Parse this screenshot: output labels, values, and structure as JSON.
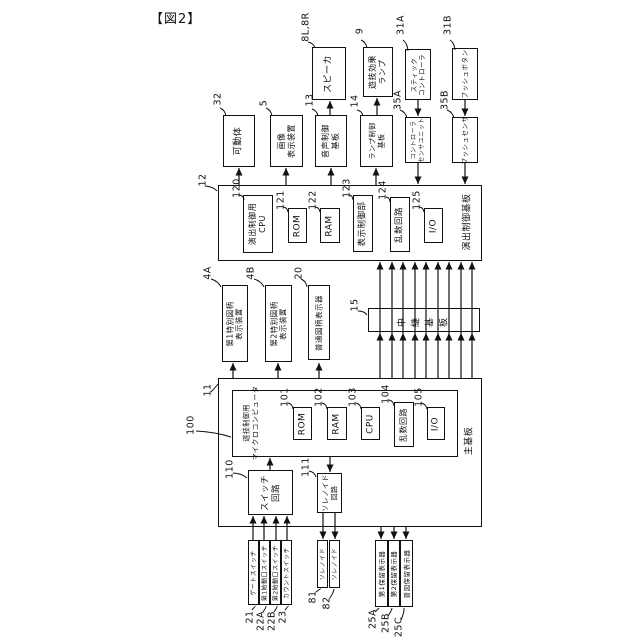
{
  "title": "【図2】",
  "colors": {
    "ink": "#111111",
    "bg": "#ffffff"
  },
  "boxes": [
    {
      "name": "speaker",
      "x": 312,
      "y": 47,
      "w": 34,
      "h": 53,
      "fs": 9,
      "lines": [
        "スピーカ"
      ]
    },
    {
      "name": "game-effect-lamp",
      "x": 363,
      "y": 47,
      "w": 30,
      "h": 50,
      "fs": 8,
      "lines": [
        "遊技効果",
        "ランプ"
      ]
    },
    {
      "name": "stick-controller",
      "x": 405,
      "y": 49,
      "w": 26,
      "h": 51,
      "fs": 6.5,
      "lines": [
        "スティック",
        "コントローラ"
      ]
    },
    {
      "name": "push-button",
      "x": 452,
      "y": 48,
      "w": 26,
      "h": 52,
      "fs": 6.5,
      "lines": [
        "プッシュボタン"
      ]
    },
    {
      "name": "movable-body",
      "x": 223,
      "y": 115,
      "w": 32,
      "h": 52,
      "fs": 9,
      "lines": [
        "可動体"
      ]
    },
    {
      "name": "image-display-device",
      "x": 270,
      "y": 115,
      "w": 33,
      "h": 52,
      "fs": 8,
      "lines": [
        "画像",
        "表示装置"
      ]
    },
    {
      "name": "sound-control-board",
      "x": 315,
      "y": 115,
      "w": 32,
      "h": 52,
      "fs": 8,
      "lines": [
        "音声制御",
        "基板"
      ]
    },
    {
      "name": "lamp-control-board",
      "x": 360,
      "y": 115,
      "w": 33,
      "h": 52,
      "fs": 7,
      "lines": [
        "ランプ制御",
        "基板"
      ]
    },
    {
      "name": "controller-sensor-unit",
      "x": 405,
      "y": 117,
      "w": 26,
      "h": 46,
      "fs": 6,
      "lines": [
        "コントローラ",
        "センサユニット"
      ]
    },
    {
      "name": "push-sensor",
      "x": 452,
      "y": 117,
      "w": 26,
      "h": 46,
      "fs": 6.5,
      "lines": [
        "プッシュセンサ"
      ]
    },
    {
      "name": "effect-control-board",
      "x": 218,
      "y": 185,
      "w": 264,
      "h": 76,
      "fs": 9,
      "lines": []
    },
    {
      "name": "effect-control-cpu",
      "x": 243,
      "y": 195,
      "w": 30,
      "h": 58,
      "fs": 8,
      "lines": [
        "演出制御用",
        "CPU"
      ]
    },
    {
      "name": "effect-rom",
      "x": 288,
      "y": 208,
      "w": 19,
      "h": 35,
      "fs": 9,
      "lines": [
        "ROM"
      ]
    },
    {
      "name": "effect-ram",
      "x": 320,
      "y": 208,
      "w": 20,
      "h": 35,
      "fs": 9,
      "lines": [
        "RAM"
      ]
    },
    {
      "name": "display-control-unit",
      "x": 353,
      "y": 195,
      "w": 20,
      "h": 57,
      "fs": 8.5,
      "lines": [
        "表示制御部"
      ]
    },
    {
      "name": "effect-random-circuit",
      "x": 390,
      "y": 197,
      "w": 20,
      "h": 55,
      "fs": 8.5,
      "lines": [
        "乱数回路"
      ]
    },
    {
      "name": "effect-io",
      "x": 424,
      "y": 208,
      "w": 19,
      "h": 35,
      "fs": 9,
      "lines": [
        "I/O"
      ]
    },
    {
      "name": "first-special-symbol-display",
      "x": 222,
      "y": 285,
      "w": 26,
      "h": 77,
      "fs": 7.5,
      "lines": [
        "第1特別図柄",
        "表示装置"
      ]
    },
    {
      "name": "second-special-symbol-display",
      "x": 265,
      "y": 285,
      "w": 27,
      "h": 77,
      "fs": 7.5,
      "lines": [
        "第2特別図柄",
        "表示装置"
      ]
    },
    {
      "name": "normal-symbol-display",
      "x": 308,
      "y": 285,
      "w": 22,
      "h": 75,
      "fs": 7.5,
      "lines": [
        "普通図柄表示器"
      ]
    },
    {
      "name": "relay-board",
      "x": 368,
      "y": 308,
      "w": 112,
      "h": 24,
      "fs": 9,
      "lines": [
        "中継基板"
      ],
      "charRotate": true
    },
    {
      "name": "main-board",
      "x": 218,
      "y": 378,
      "w": 264,
      "h": 149,
      "fs": 9,
      "lines": []
    },
    {
      "name": "game-control-microcomputer",
      "x": 232,
      "y": 390,
      "w": 226,
      "h": 67,
      "fs": 7,
      "lines": []
    },
    {
      "name": "main-rom",
      "x": 293,
      "y": 407,
      "w": 19,
      "h": 33,
      "fs": 9,
      "lines": [
        "ROM"
      ]
    },
    {
      "name": "main-ram",
      "x": 327,
      "y": 407,
      "w": 20,
      "h": 33,
      "fs": 9,
      "lines": [
        "RAM"
      ]
    },
    {
      "name": "main-cpu",
      "x": 361,
      "y": 407,
      "w": 19,
      "h": 33,
      "fs": 9,
      "lines": [
        "CPU"
      ]
    },
    {
      "name": "main-random-circuit",
      "x": 394,
      "y": 402,
      "w": 20,
      "h": 45,
      "fs": 8,
      "lines": [
        "乱数回路"
      ]
    },
    {
      "name": "main-io",
      "x": 427,
      "y": 407,
      "w": 18,
      "h": 33,
      "fs": 9,
      "lines": [
        "I/O"
      ]
    },
    {
      "name": "switch-circuit",
      "x": 248,
      "y": 470,
      "w": 45,
      "h": 45,
      "fs": 8.5,
      "lines": [
        "スイッチ",
        "回路"
      ]
    },
    {
      "name": "solenoid-circuit",
      "x": 317,
      "y": 473,
      "w": 25,
      "h": 40,
      "fs": 7,
      "lines": [
        "ソレノイド",
        "回路"
      ]
    },
    {
      "name": "gate-switch",
      "x": 248,
      "y": 540,
      "w": 11,
      "h": 65,
      "fs": 6,
      "lines": [
        "ゲートスイッチ"
      ]
    },
    {
      "name": "first-start-switch",
      "x": 259,
      "y": 540,
      "w": 11,
      "h": 65,
      "fs": 6,
      "lines": [
        "第1始動口スイッチ"
      ]
    },
    {
      "name": "second-start-switch",
      "x": 270,
      "y": 540,
      "w": 11,
      "h": 65,
      "fs": 6,
      "lines": [
        "第2始動口スイッチ"
      ]
    },
    {
      "name": "count-switch",
      "x": 281,
      "y": 540,
      "w": 11,
      "h": 65,
      "fs": 6,
      "lines": [
        "カウントスイッチ"
      ]
    },
    {
      "name": "solenoid-81",
      "x": 317,
      "y": 540,
      "w": 11,
      "h": 48,
      "fs": 6,
      "lines": [
        "ソレノイド"
      ]
    },
    {
      "name": "solenoid-82",
      "x": 329,
      "y": 540,
      "w": 11,
      "h": 48,
      "fs": 6,
      "lines": [
        "ソレノイド"
      ]
    },
    {
      "name": "first-hold-display",
      "x": 375,
      "y": 540,
      "w": 13,
      "h": 67,
      "fs": 6.5,
      "lines": [
        "第1保留表示器"
      ]
    },
    {
      "name": "second-hold-display",
      "x": 388,
      "y": 540,
      "w": 12,
      "h": 67,
      "fs": 6.5,
      "lines": [
        "第2保留表示器"
      ]
    },
    {
      "name": "normal-hold-display",
      "x": 400,
      "y": 540,
      "w": 13,
      "h": 67,
      "fs": 6.5,
      "lines": [
        "普図保留表示器"
      ]
    }
  ],
  "labels": [
    {
      "name": "effect-board-label",
      "cx": 468,
      "cy": 222,
      "fs": 9,
      "lines": [
        "演出制御基板"
      ]
    },
    {
      "name": "main-board-label",
      "cx": 470,
      "cy": 441,
      "fs": 9,
      "lines": [
        "主基板"
      ]
    },
    {
      "name": "microcomputer-label",
      "cx": 251,
      "cy": 423,
      "fs": 7,
      "lines": [
        "遊技制御用",
        "マイクロコンピュータ"
      ]
    }
  ],
  "refs": [
    [
      "8L,8R",
      306,
      27
    ],
    [
      "9",
      360,
      31
    ],
    [
      "31A",
      401,
      25
    ],
    [
      "31B",
      448,
      25
    ],
    [
      "32",
      218,
      99
    ],
    [
      "5",
      264,
      103
    ],
    [
      "13",
      310,
      100
    ],
    [
      "14",
      355,
      101
    ],
    [
      "35A",
      398,
      100
    ],
    [
      "35B",
      445,
      100
    ],
    [
      "12",
      203,
      180
    ],
    [
      "120",
      237,
      188
    ],
    [
      "121",
      281,
      200
    ],
    [
      "122",
      313,
      200
    ],
    [
      "123",
      347,
      188
    ],
    [
      "124",
      383,
      190
    ],
    [
      "125",
      417,
      200
    ],
    [
      "4A",
      208,
      273
    ],
    [
      "4B",
      251,
      273
    ],
    [
      "20",
      299,
      273
    ],
    [
      "15",
      355,
      305
    ],
    [
      "11",
      208,
      390
    ],
    [
      "100",
      191,
      425
    ],
    [
      "101",
      285,
      397
    ],
    [
      "102",
      319,
      397
    ],
    [
      "103",
      353,
      397
    ],
    [
      "104",
      386,
      394
    ],
    [
      "105",
      419,
      397
    ],
    [
      "110",
      230,
      469
    ],
    [
      "111",
      306,
      467
    ],
    [
      "21",
      250,
      617
    ],
    [
      "22A",
      261,
      621
    ],
    [
      "22B",
      272,
      621
    ],
    [
      "23",
      283,
      617
    ],
    [
      "81",
      313,
      597
    ],
    [
      "82",
      327,
      603
    ],
    [
      "25A",
      373,
      619
    ],
    [
      "25B",
      386,
      623
    ],
    [
      "25C",
      399,
      627
    ]
  ],
  "lines": [
    [
      330,
      115,
      330,
      101
    ],
    [
      377,
      115,
      377,
      98
    ],
    [
      418,
      100,
      418,
      116
    ],
    [
      465,
      100,
      465,
      116
    ],
    [
      418,
      163,
      418,
      184
    ],
    [
      465,
      163,
      465,
      184
    ],
    [
      239,
      185,
      239,
      168
    ],
    [
      286,
      185,
      286,
      168
    ],
    [
      331,
      185,
      331,
      168
    ],
    [
      376,
      185,
      376,
      168
    ],
    [
      380,
      378,
      380,
      262
    ],
    [
      392,
      378,
      392,
      262
    ],
    [
      403,
      378,
      403,
      262
    ],
    [
      415,
      378,
      415,
      262
    ],
    [
      426,
      378,
      426,
      262
    ],
    [
      438,
      378,
      438,
      262
    ],
    [
      449,
      378,
      449,
      262
    ],
    [
      461,
      378,
      461,
      262
    ],
    [
      472,
      378,
      472,
      262
    ],
    [
      233,
      378,
      233,
      363
    ],
    [
      278,
      378,
      278,
      363
    ],
    [
      319,
      378,
      319,
      363
    ],
    [
      270,
      470,
      270,
      458
    ],
    [
      330,
      457,
      330,
      472
    ],
    [
      253,
      540,
      253,
      516
    ],
    [
      264,
      540,
      264,
      516
    ],
    [
      276,
      540,
      276,
      516
    ],
    [
      287,
      540,
      287,
      516
    ],
    [
      323,
      513,
      323,
      539
    ],
    [
      335,
      513,
      335,
      539
    ],
    [
      381,
      527,
      381,
      539
    ],
    [
      394,
      527,
      394,
      539
    ],
    [
      406,
      527,
      406,
      539
    ]
  ],
  "arrowheads": [
    [
      330,
      101,
      "u"
    ],
    [
      377,
      98,
      "u"
    ],
    [
      418,
      116,
      "d"
    ],
    [
      465,
      116,
      "d"
    ],
    [
      418,
      184,
      "d"
    ],
    [
      465,
      184,
      "d"
    ],
    [
      239,
      168,
      "u"
    ],
    [
      286,
      168,
      "u"
    ],
    [
      331,
      168,
      "u"
    ],
    [
      376,
      168,
      "u"
    ],
    [
      380,
      262,
      "u"
    ],
    [
      392,
      262,
      "u"
    ],
    [
      403,
      262,
      "u"
    ],
    [
      415,
      262,
      "u"
    ],
    [
      426,
      262,
      "u"
    ],
    [
      438,
      262,
      "u"
    ],
    [
      449,
      262,
      "u"
    ],
    [
      461,
      262,
      "u"
    ],
    [
      472,
      262,
      "u"
    ],
    [
      380,
      333,
      "u"
    ],
    [
      392,
      333,
      "u"
    ],
    [
      403,
      333,
      "u"
    ],
    [
      415,
      333,
      "u"
    ],
    [
      426,
      333,
      "u"
    ],
    [
      438,
      333,
      "u"
    ],
    [
      449,
      333,
      "u"
    ],
    [
      461,
      333,
      "u"
    ],
    [
      472,
      333,
      "u"
    ],
    [
      233,
      363,
      "u"
    ],
    [
      278,
      363,
      "u"
    ],
    [
      319,
      363,
      "u"
    ],
    [
      270,
      458,
      "u"
    ],
    [
      330,
      472,
      "d"
    ],
    [
      253,
      516,
      "u"
    ],
    [
      264,
      516,
      "u"
    ],
    [
      276,
      516,
      "u"
    ],
    [
      287,
      516,
      "u"
    ],
    [
      323,
      539,
      "d"
    ],
    [
      335,
      539,
      "d"
    ],
    [
      381,
      539,
      "d"
    ],
    [
      394,
      539,
      "d"
    ],
    [
      406,
      539,
      "d"
    ]
  ],
  "leaders": [
    [
      308,
      42,
      315,
      48
    ],
    [
      361,
      40,
      367,
      48
    ],
    [
      403,
      40,
      408,
      51
    ],
    [
      450,
      40,
      455,
      50
    ],
    [
      220,
      108,
      226,
      116
    ],
    [
      266,
      108,
      272,
      116
    ],
    [
      312,
      109,
      318,
      116
    ],
    [
      357,
      110,
      363,
      116
    ],
    [
      400,
      110,
      407,
      118
    ],
    [
      447,
      110,
      454,
      118
    ],
    [
      205,
      186,
      217,
      191
    ],
    [
      239,
      195,
      244,
      200
    ],
    [
      283,
      207,
      288,
      212
    ],
    [
      315,
      207,
      320,
      212
    ],
    [
      349,
      195,
      353,
      200
    ],
    [
      386,
      197,
      390,
      202
    ],
    [
      419,
      207,
      424,
      212
    ],
    [
      211,
      279,
      221,
      287
    ],
    [
      254,
      279,
      264,
      287
    ],
    [
      301,
      279,
      307,
      287
    ],
    [
      358,
      311,
      367,
      315
    ],
    [
      211,
      392,
      218,
      384
    ],
    [
      196,
      431,
      231,
      437
    ],
    [
      288,
      403,
      293,
      409
    ],
    [
      322,
      403,
      327,
      409
    ],
    [
      356,
      403,
      361,
      409
    ],
    [
      389,
      400,
      394,
      406
    ],
    [
      421,
      403,
      427,
      409
    ],
    [
      233,
      473,
      247,
      478
    ],
    [
      309,
      471,
      316,
      477
    ],
    [
      252,
      610,
      255,
      606
    ],
    [
      263,
      612,
      266,
      606
    ],
    [
      274,
      612,
      277,
      606
    ],
    [
      285,
      610,
      288,
      606
    ],
    [
      316,
      592,
      321,
      589
    ],
    [
      330,
      598,
      334,
      589
    ],
    [
      375,
      612,
      379,
      608
    ],
    [
      388,
      616,
      392,
      608
    ],
    [
      401,
      620,
      404,
      608
    ]
  ]
}
